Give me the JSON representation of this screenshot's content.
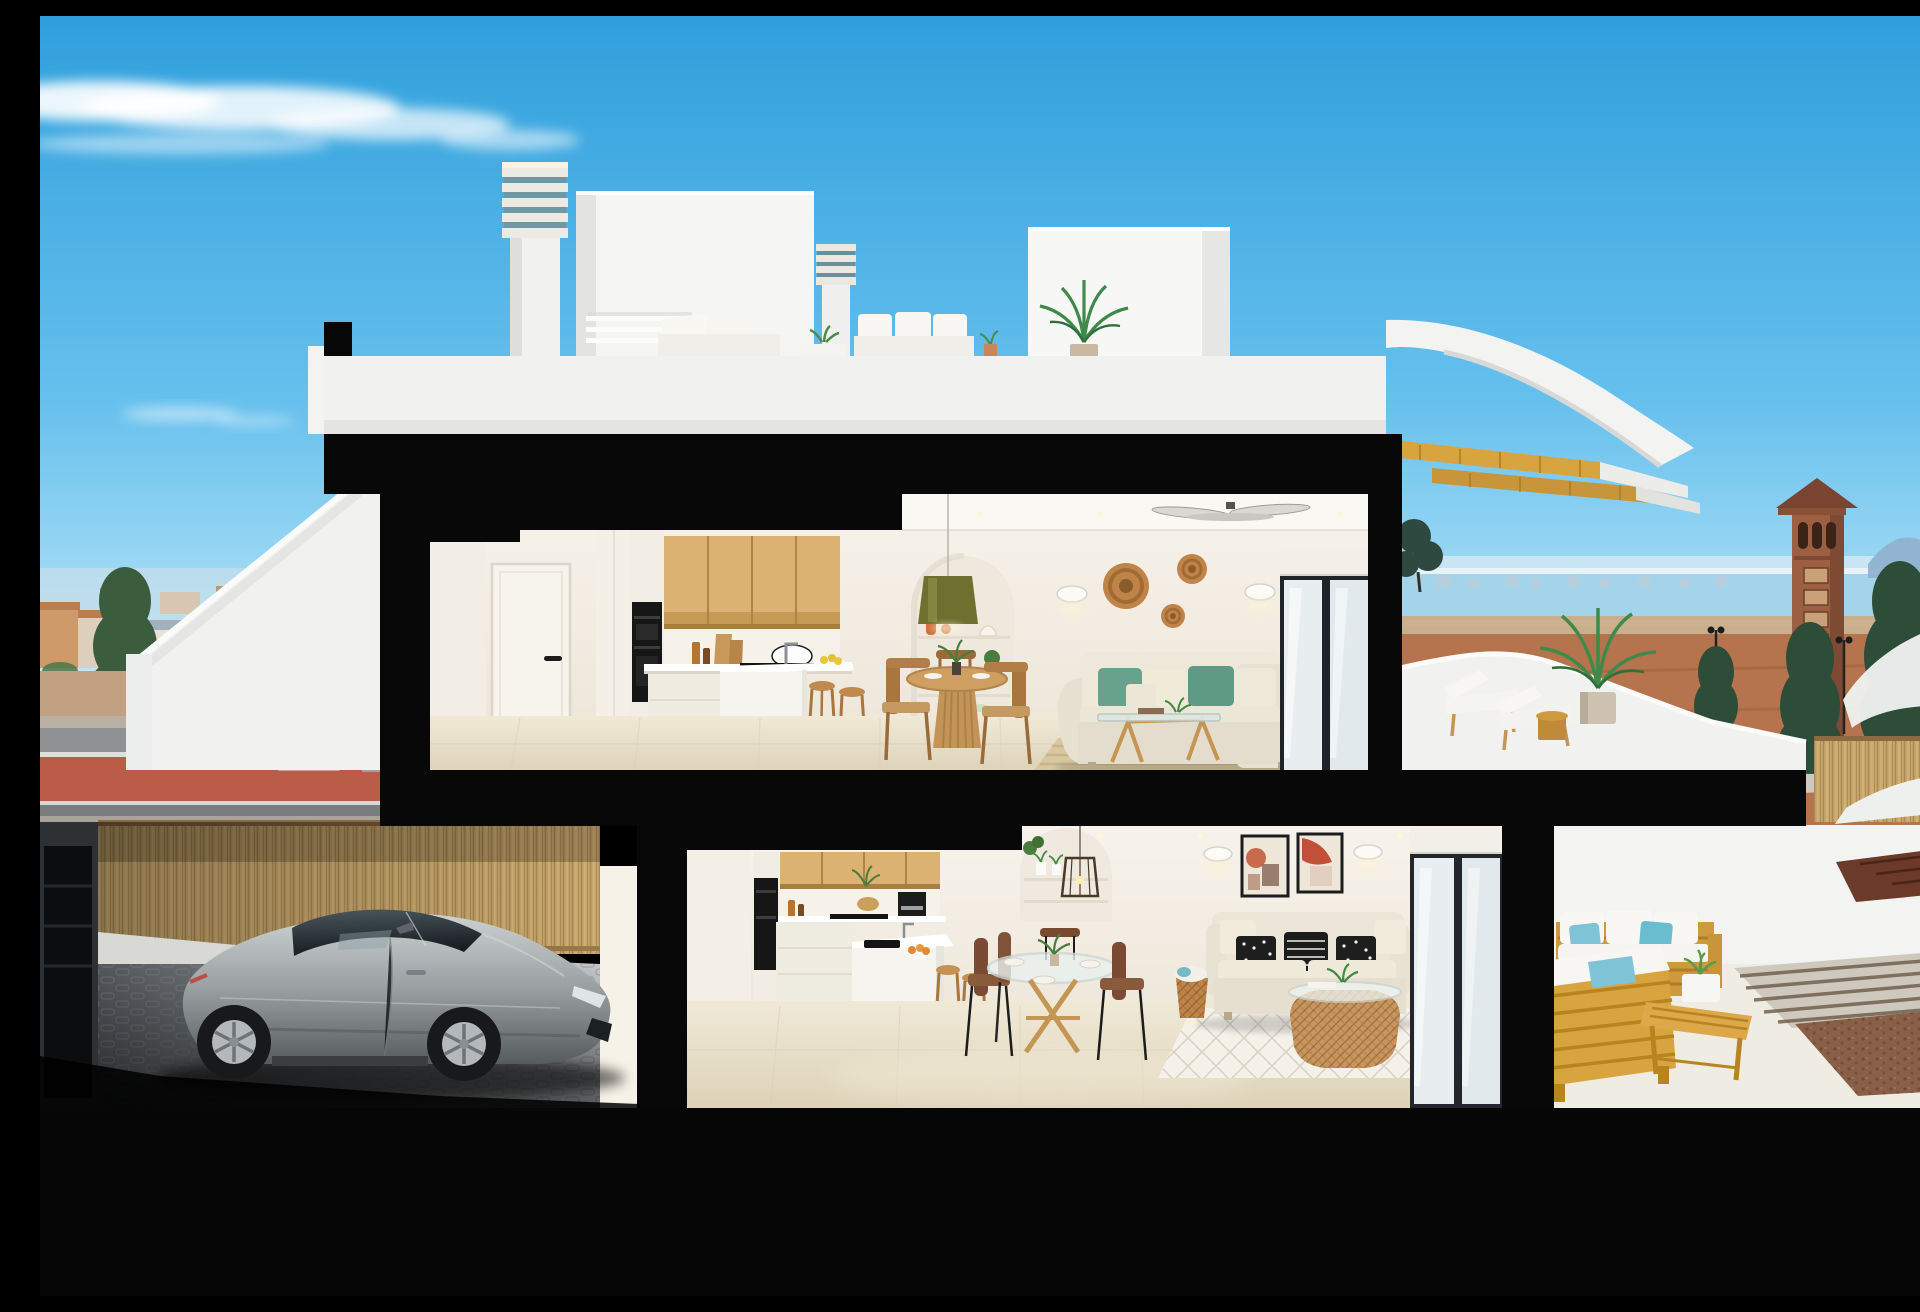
{
  "meta": {
    "type": "3d-architectural-cutaway-render",
    "description": "Cutaway cross-section 3D render of a white two-storey Mediterranean duplex: roof terrace with chimneys and white outdoor sofa, upper flat with oak kitchen, round dining table, cream sofa with teal cushions and sun terrace with loungers and palm, lower flat with oak kitchen, glass dining table, beige sofa with black-and-white cushions and wooden outdoor lounge terrace, garage with a silver sports coupe behind a bamboo fence, blue sky, coastal town, sea and watchtower in the background."
  },
  "palette": {
    "sky_top": "#2f9fdc",
    "sky_mid": "#66c0ed",
    "sky_horizon": "#c9ecf9",
    "cloud_white": "#ffffff",
    "section_black": "#080808",
    "exterior_white": "#f3f4f2",
    "parapet_white": "#f1f2f0",
    "interior_wall": "#f6f2ea",
    "interior_wall_dark": "#eee7da",
    "ceiling_white": "#faf8f3",
    "wood_cabinet_light": "#dcb272",
    "wood_cabinet_dark": "#c79a55",
    "wood_furniture": "#c49553",
    "wood_outdoor": "#d8a440",
    "floor_tile": "#f0e9d6",
    "floor_tile_dark": "#e0d5bc",
    "sofa_cream": "#eae4d5",
    "cushion_teal": "#68a18c",
    "cushion_blue": "#7ec4d6",
    "cushion_black": "#1e1e1e",
    "rattan": "#c08448",
    "olive_lamp": "#6f7030",
    "sea_blue": "#a3d4ea",
    "town_roof": "#b97d52",
    "tree_green": "#466b46",
    "tree_dark": "#2e4d38",
    "dirt_field": "#b5744d",
    "road_gray": "#8f9092",
    "bike_lane_red": "#bb5c49",
    "bamboo_tan": "#c9a76b",
    "gravel_brown": "#8a5f48",
    "car_silver_light": "#cdd1d2",
    "car_silver": "#9aa0a2",
    "car_silver_dark": "#565c5e",
    "car_glass_dark": "#161b1f",
    "tower_brown": "#9c5f42",
    "art_terracotta": "#c96a4e",
    "glow_warm": "#fff3cd"
  },
  "scene": {
    "sky": {
      "clouds": [
        "large wispy cloud top-left",
        "small faint cloud mid-left"
      ]
    },
    "background_left": {
      "items": [
        "town rooftops",
        "pine trees",
        "street lamp",
        "round blue traffic sign",
        "road with red bike lane"
      ]
    },
    "background_right": {
      "items": [
        "sea horizon",
        "distant skyline",
        "mountains",
        "brown watchtower",
        "cypress trees",
        "dirt field with roads",
        "street lanterns",
        "bamboo fence",
        "white curved walls"
      ]
    },
    "roof_level": {
      "items": [
        "louvered chimney left",
        "louvered chimney right",
        "stair bulkhead",
        "white roof volume",
        "white outdoor sofa set",
        "potted palm",
        "white parapet",
        "curved white canopy",
        "golden wood stair"
      ]
    },
    "upper_floor": {
      "kitchen": [
        "white door",
        "wardrobe",
        "built-in oven",
        "oak wall cabinets",
        "white counter with pot",
        "island with faucet and lemon bowl",
        "two wooden stools"
      ],
      "living": [
        "arched shelf niche",
        "olive pendant lamp",
        "two wall sconces",
        "three rattan wall baskets",
        "round wooden dining table",
        "four wooden chairs",
        "cream corner sofa with teal cushions",
        "glass coffee table",
        "striped beige rug",
        "ceiling fan",
        "sliding glass door"
      ]
    },
    "upper_terrace": {
      "items": [
        "curved white parapet",
        "two sun loungers",
        "round side table",
        "potted palm",
        "dark tree silhouette"
      ]
    },
    "lower_floor": {
      "kitchen": [
        "built-in oven",
        "oak wall cabinets",
        "coffee machine",
        "island with sink and fruit bowl",
        "two wooden stools"
      ],
      "living": [
        "arched shelf niche",
        "rattan cage pendant",
        "two framed abstract artworks",
        "two wall sconces",
        "glass round dining table",
        "dark wooden chairs",
        "beige sofa with black and white cushions",
        "rattan basket coffee table",
        "diamond-pattern white rug",
        "storage basket with blanket",
        "sliding glass doors"
      ]
    },
    "lower_terrace": {
      "items": [
        "wooden outdoor sofas with white cushions and light-blue pillows",
        "wooden coffee table with planter",
        "paved walkway",
        "gravel bed"
      ]
    },
    "garage": {
      "items": [
        "bamboo fence",
        "low white wall",
        "cobblestone drive",
        "silver sports coupe",
        "dark side wall"
      ]
    }
  }
}
